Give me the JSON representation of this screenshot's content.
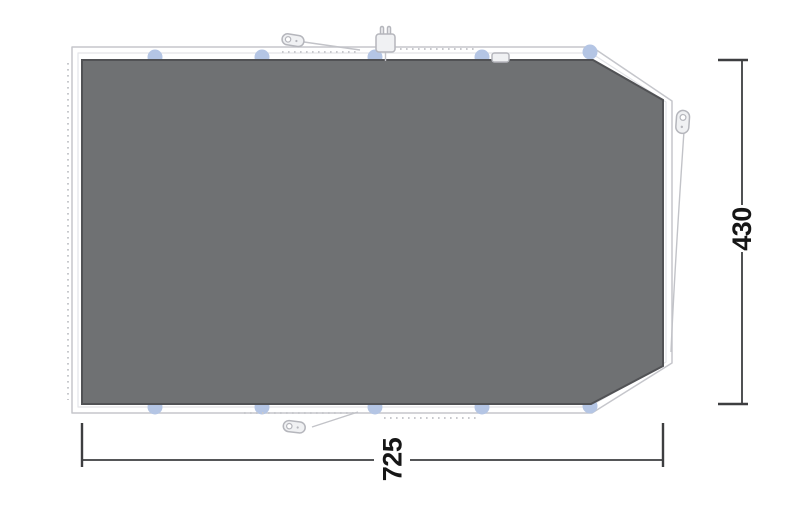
{
  "diagram": {
    "title": "Tent footprint groundsheet dimension drawing"
  },
  "dimensions": {
    "width": "725",
    "height": "430"
  },
  "attachment_tabs": {
    "top_count": 5,
    "bottom_count": 5
  },
  "icons": {
    "top_guyline_peg": "guyline-peg-icon",
    "bottom_guyline_peg": "guyline-peg-icon",
    "cable_entry": "power-plug-icon",
    "right_hanging_loop": "hanging-loop-icon",
    "edge_buckle": "strap-buckle-icon"
  },
  "colors": {
    "groundsheet_fill": "#6f7173",
    "groundsheet_edge": "#515255",
    "outline_stroke": "#c5c6cb",
    "inner_outline_stroke": "#e3e4e8",
    "tab_fill": "#b4c5e4",
    "dotted_stroke": "#c8c9cd",
    "guyline_stroke": "#c2c3c8",
    "icon_fill": "#f0f1f3",
    "icon_stroke": "#b5b6bc",
    "dimension_stroke": "#3d3e40",
    "dimension_text": "#161616"
  }
}
